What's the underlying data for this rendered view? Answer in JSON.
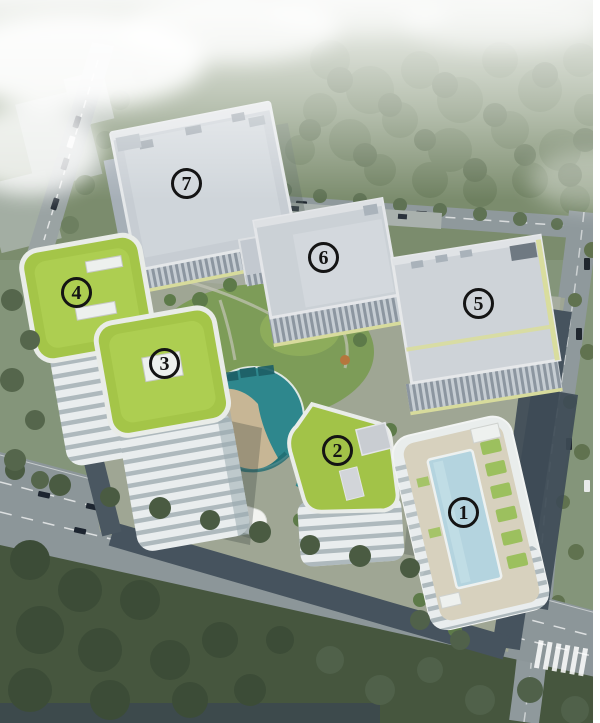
{
  "scene": {
    "labels": [
      {
        "name": "building-1",
        "number": "1"
      },
      {
        "name": "building-2",
        "number": "2"
      },
      {
        "name": "building-3",
        "number": "3"
      },
      {
        "name": "building-4",
        "number": "4"
      },
      {
        "name": "building-5",
        "number": "5"
      },
      {
        "name": "building-6",
        "number": "6"
      },
      {
        "name": "building-7",
        "number": "7"
      }
    ]
  },
  "colors": {
    "green_roof": "#a4c548",
    "gray_roof": "#cbd1d6",
    "facade_ribbon": "#e9edee",
    "water_feature_teal": "#2e878d",
    "rooftop_pool_blue": "#b4d4df",
    "road_dark": "#46535e",
    "road_light": "#8f999c",
    "forest_green": "#4b5b42",
    "label_ink": "#141414"
  }
}
